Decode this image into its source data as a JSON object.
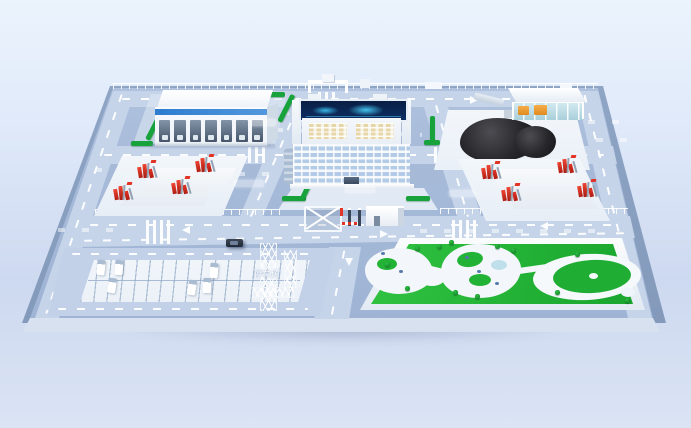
{
  "scene": {
    "description": "3D isometric render of an industrial smart-park campus model on a raised blue platform",
    "labels": {
      "parking_lot": "停车场"
    },
    "areas": [
      "warehouse",
      "office-building",
      "coal-yard",
      "equipment-yard-left",
      "equipment-yard-right",
      "parking-lot",
      "entrance-gate",
      "garden-park"
    ],
    "counts": {
      "warehouse_dock_doors": 7,
      "office_window_rows": 6,
      "trucks_in_parking": 6,
      "equipment_rig_clusters": 8,
      "lattice_towers": 2
    },
    "colors": {
      "sky_top": "#ebf3fc",
      "sky_bottom": "#dbe4f4",
      "platform_top": "#a6bad8",
      "platform_side": "#8298b8",
      "road": "#c6d4ea",
      "road_marking": "#ffffff",
      "building_white": "#f7fafd",
      "building_blue_stripe": "#2c7ccf",
      "led_screen_navy": "#0c2f63",
      "led_screen_glow": "#38b7e8",
      "penthouse_window_cream": "#e7d6a8",
      "hedge_green": "#17a23b",
      "grass_green": "#1fae33",
      "coal_black": "#141416",
      "equipment_red": "#e23327",
      "machinery_orange": "#f0952f",
      "glass_teal": "#a9cfda"
    }
  }
}
